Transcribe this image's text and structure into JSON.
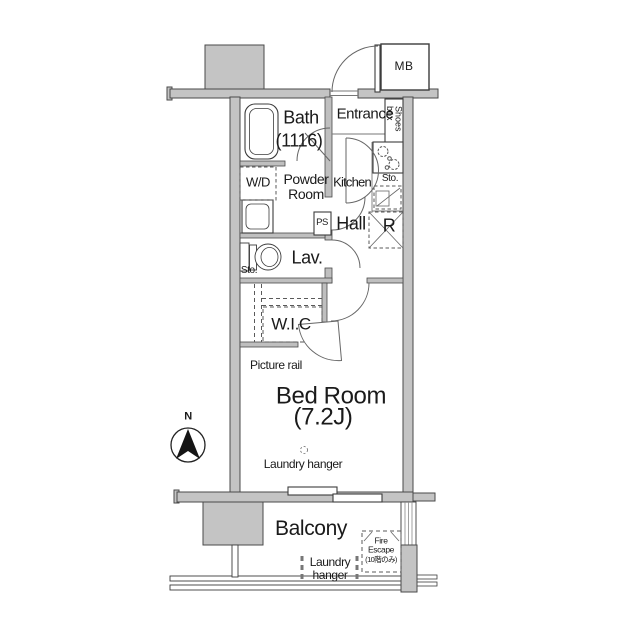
{
  "colors": {
    "background": "#ffffff",
    "wall_fill": "#c4c4c4",
    "wall_edge": "#4a4a4a",
    "line": "#666666",
    "text": "#1a1a1a"
  },
  "plan": {
    "meter_box": "MB",
    "bath": {
      "name": "Bath",
      "size": "(1116)"
    },
    "entrance": {
      "name": "Entrance",
      "shoes_box": "Shoes box"
    },
    "powder_room": {
      "name": "Powder Room",
      "washer_dryer": "W/D",
      "pipe_space": "PS"
    },
    "kitchen": {
      "name": "Kitchen",
      "storage": "Sto."
    },
    "hall": {
      "name": "Hall",
      "refrigerator": "R"
    },
    "lavatory": {
      "name": "Lav.",
      "storage": "Sto."
    },
    "walk_in_closet": {
      "name": "W.I.C"
    },
    "bedroom": {
      "name": "Bed Room",
      "size": "(7.2J)",
      "picture_rail": "Picture rail",
      "laundry_hanger": "Laundry hanger"
    },
    "balcony": {
      "name": "Balcony",
      "laundry_hanger": "Laundry hanger",
      "fire_escape": {
        "line1": "Fire",
        "line2": "Escape",
        "line3": "(10階のみ)"
      }
    },
    "compass": {
      "north": "N"
    }
  }
}
